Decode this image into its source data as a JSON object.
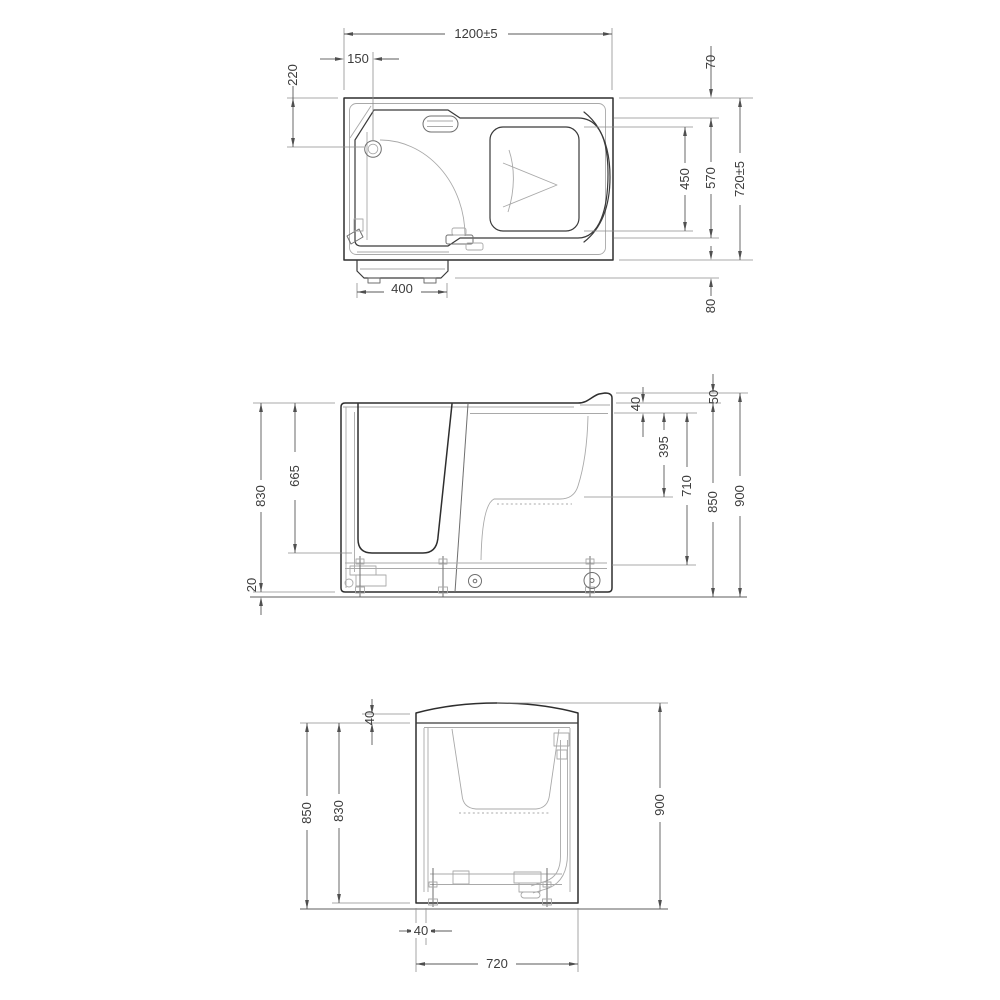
{
  "title": "Walk-in bathtub technical drawing, three orthographic views",
  "colors": {
    "background": "#ffffff",
    "outline": "#2e2e2e",
    "detail": "#a9a9a9",
    "dimension": "#585858"
  },
  "views": {
    "top": {
      "label": "top-view",
      "dims": {
        "overall_length": "1200±5",
        "tap_center_from_left": "150",
        "tap_center_from_front": "220",
        "back_ledge": "70",
        "seat_depth": "450",
        "basin_width": "570",
        "overall_width": "720±5",
        "door_step": "80",
        "door_step_width": "400"
      }
    },
    "front": {
      "label": "front-view",
      "dims": {
        "rim_to_base": "830",
        "rim_to_door_sill": "665",
        "base_clearance": "20",
        "rim_thickness": "40",
        "rim_to_seat": "395",
        "inner_depth": "710",
        "rim_height": "850",
        "overall_height": "900",
        "backrest_lip": "50"
      }
    },
    "side": {
      "label": "side-view",
      "dims": {
        "top_edge_to_rim": "40",
        "rim_height": "850",
        "rim_to_base": "830",
        "overall_height": "900",
        "foot_inset": "40",
        "overall_width": "720"
      }
    }
  }
}
